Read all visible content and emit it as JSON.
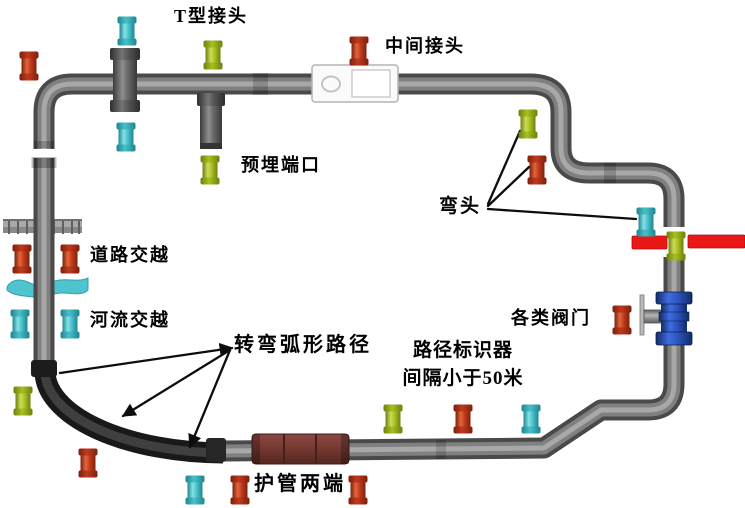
{
  "diagram": {
    "labels": {
      "t_joint": "T型接头",
      "mid_joint": "中间接头",
      "embed_port": "预埋端口",
      "elbow": "弯头",
      "road_cross": "道路交越",
      "river_cross": "河流交越",
      "arc_path": "转弯弧形路径",
      "path_marker_1": "路径标识器",
      "path_marker_2": "间隔小于50米",
      "valves": "各类阀门",
      "casing_ends": "护管两端"
    },
    "colors": {
      "pipe": "#6e6e6e",
      "pipe_dark": "#4a4a4a",
      "arc_pipe": "#1c1c1c",
      "casing": "#6e3531",
      "valve_blue": "#2a50b8",
      "road_bar_red": "#ea1717",
      "river_cyan": "#4fc4ce",
      "joint_box": "#fbfbfb"
    },
    "marker_colors": {
      "red": {
        "light": "#e2653c",
        "base": "#c03a1e",
        "dark": "#7d1f0a"
      },
      "cyan": {
        "light": "#84e2e6",
        "base": "#49c0c9",
        "dark": "#1d868f"
      },
      "green": {
        "light": "#ccdc55",
        "base": "#a9c021",
        "dark": "#6f7f0e"
      }
    },
    "markers": [
      {
        "x": 127,
        "y": 31,
        "color": "cyan"
      },
      {
        "x": 29,
        "y": 66,
        "color": "red"
      },
      {
        "x": 213,
        "y": 55,
        "color": "green"
      },
      {
        "x": 126,
        "y": 137,
        "color": "cyan"
      },
      {
        "x": 210,
        "y": 170,
        "color": "green"
      },
      {
        "x": 359,
        "y": 51,
        "color": "red"
      },
      {
        "x": 528,
        "y": 124,
        "color": "green"
      },
      {
        "x": 537,
        "y": 170,
        "color": "red"
      },
      {
        "x": 646,
        "y": 222,
        "color": "cyan"
      },
      {
        "x": 676,
        "y": 246,
        "color": "green"
      },
      {
        "x": 622,
        "y": 320,
        "color": "red"
      },
      {
        "x": 22,
        "y": 259,
        "color": "red"
      },
      {
        "x": 70,
        "y": 259,
        "color": "red"
      },
      {
        "x": 20,
        "y": 324,
        "color": "cyan"
      },
      {
        "x": 70,
        "y": 324,
        "color": "cyan"
      },
      {
        "x": 23,
        "y": 401,
        "color": "green"
      },
      {
        "x": 88,
        "y": 463,
        "color": "red"
      },
      {
        "x": 195,
        "y": 490,
        "color": "cyan"
      },
      {
        "x": 240,
        "y": 490,
        "color": "red"
      },
      {
        "x": 358,
        "y": 490,
        "color": "red"
      },
      {
        "x": 393,
        "y": 419,
        "color": "green"
      },
      {
        "x": 463,
        "y": 419,
        "color": "red"
      },
      {
        "x": 531,
        "y": 419,
        "color": "cyan"
      }
    ]
  }
}
